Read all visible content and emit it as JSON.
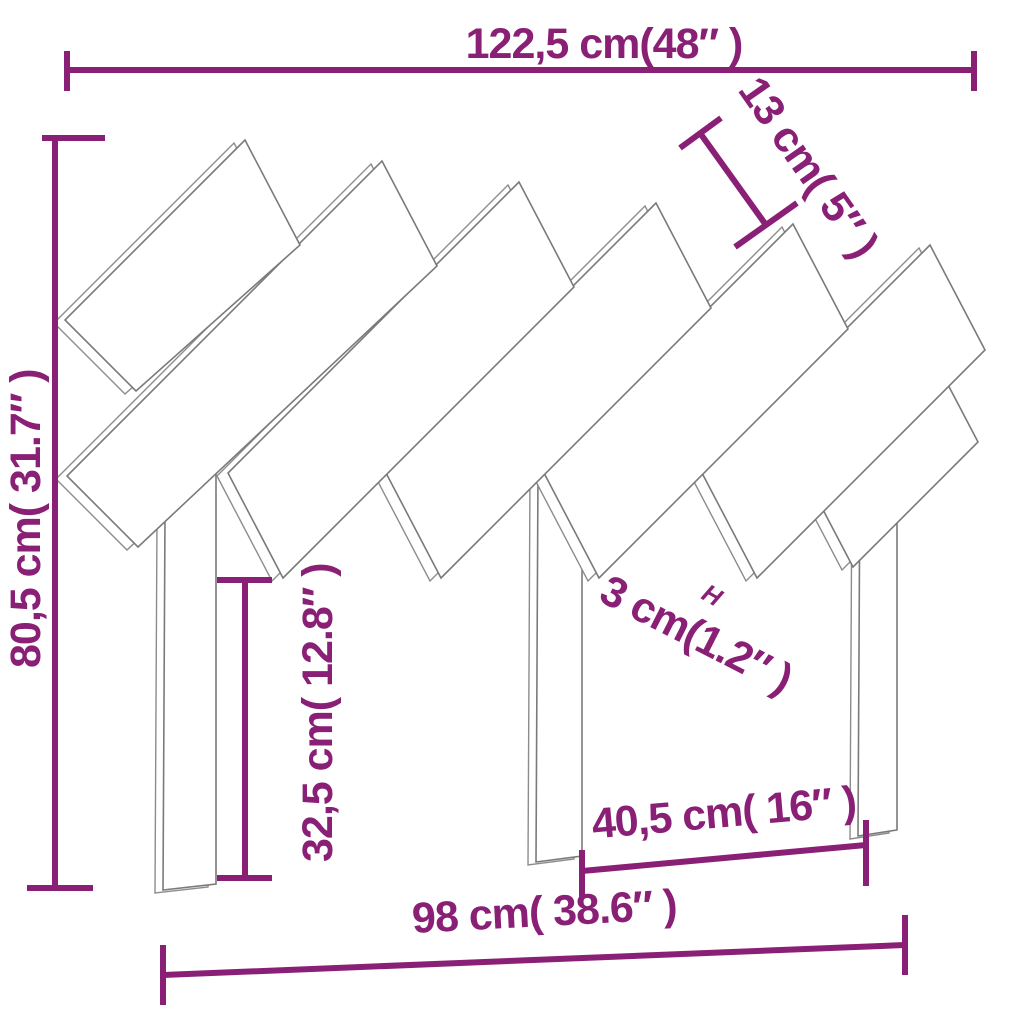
{
  "diagram": {
    "subject": "headboard-with-diagonal-slats",
    "labels": {
      "top_width": "122,5 cm(48″ )",
      "slat_width": "13 cm( 5″ )",
      "total_height": "80,5 cm( 31.7″ )",
      "leg_height": "32,5 cm( 12.8″ )",
      "slat_thickness": "3 cm(1.2″ )",
      "thickness_marker": "H",
      "leg_spacing": "40,5 cm( 16″ )",
      "bottom_width": "98 cm( 38.6″ )"
    },
    "colors": {
      "dimension": "#8A2076",
      "outline": "#7A7A7A",
      "background": "#FFFFFF"
    }
  }
}
